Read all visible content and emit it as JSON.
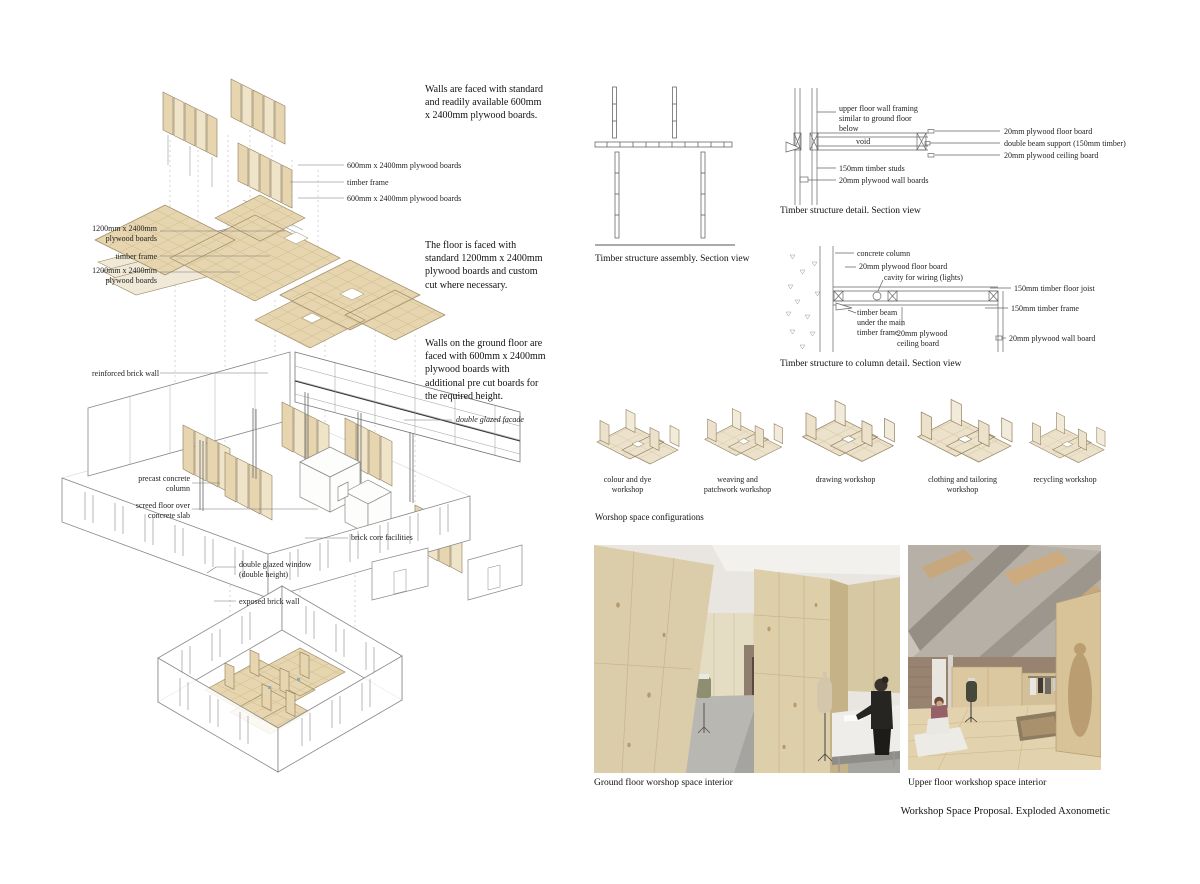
{
  "page": {
    "title": "Workshop Space Proposal. Exploded Axonometic"
  },
  "colors": {
    "plywood": "#e6d5ae",
    "plywood_light": "#f1e9d8",
    "plate_outline": "#9c8a64",
    "drawing_line": "#666666",
    "concrete_grey": "#b3aca2",
    "brick_brown": "#97836f"
  },
  "axon": {
    "notes": {
      "walls": "Walls are faced with standard\nand readily available 600mm\nx 2400mm plywood boards.",
      "floor": "The floor is faced with\nstandard 1200mm x 2400mm\nplywood boards and custom\ncut where necessary.",
      "ground": "Walls on the ground floor are\nfaced with 600mm x 2400mm\nplywood boards with\nadditional pre cut boards for\nthe required height."
    },
    "labels": {
      "boards600_top": "600mm x 2400mm plywood boards",
      "timber_frame_top": "timber frame",
      "boards600_bottom": "600mm x 2400mm plywood boards",
      "boards1200_top": "1200mm x 2400mm\nplywood boards",
      "timber_frame_mid": "timber frame",
      "boards1200_bottom": "1200mm x 2400mm\nplywood boards",
      "reinforced_brick_wall": "reinforced brick wall",
      "double_glazed_facade": "double glazed facade",
      "precast_concrete_column": "precast concrete\ncolumn",
      "screed_floor": "screed floor over\nconcrete slab",
      "double_glazed_window": "double glazed window\n(double height)",
      "exposed_brick_wall": "exposed brick wall",
      "brick_core_facilities": "brick core facilities"
    }
  },
  "sections": {
    "assembly": {
      "caption": "Timber structure assembly. Section view"
    },
    "detail": {
      "caption": "Timber structure detail. Section view",
      "labels": {
        "upper_framing": "upper floor wall framing\nsimilar to ground floor\nbelow",
        "void": "void",
        "studs": "150mm timber studs",
        "wall_boards": "20mm plywood wall boards",
        "floor_board": "20mm plywood floor board",
        "double_beam": "double beam support (150mm timber)",
        "ceiling_board": "20mm plywood ceiling board"
      }
    },
    "column_detail": {
      "caption": "Timber structure to column detail. Section view",
      "labels": {
        "concrete_column": "concrete column",
        "floor_board": "20mm plywood floor board",
        "cavity": "cavity for wiring (lights)",
        "timber_beam": "timber beam\nunder the main\ntimber frame",
        "ceiling_board": "20mm plywood\nceiling board",
        "floor_joist": "150mm timber floor joist",
        "timber_frame": "150mm timber frame",
        "wall_board": "20mm plywood wall board"
      }
    }
  },
  "configs": {
    "caption": "Worshop space configurations",
    "items": [
      {
        "label": "colour and dye\nworkshop"
      },
      {
        "label": "weaving and\npatchwork workshop"
      },
      {
        "label": "drawing workshop"
      },
      {
        "label": "clothing and tailoring\nworkshop"
      },
      {
        "label": "recycling workshop"
      }
    ]
  },
  "renders": {
    "ground": "Ground floor worshop space interior",
    "upper": "Upper floor workshop space interior"
  }
}
